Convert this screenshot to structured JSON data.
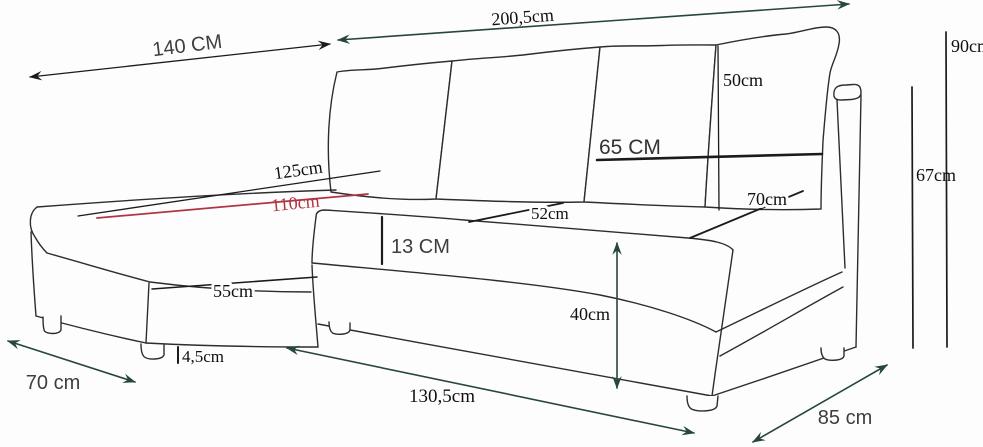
{
  "diagram": {
    "kind": "corner-sofa dimension drawing",
    "background": "#fdfdfd",
    "palette": {
      "sofa_outline": "#2d2d2d",
      "black_dimension": "#1b1b1b",
      "green_dimension": "#26473a",
      "red_dimension": "#b13441",
      "sans_label_color": "#3e3e3e",
      "serif_label_color": "#101010"
    },
    "dims": {
      "d140": {
        "label": "140 CM"
      },
      "d200_5": {
        "label": "200,5cm"
      },
      "d90": {
        "label": "90cm"
      },
      "d67": {
        "label": "67cm"
      },
      "d50": {
        "label": "50cm"
      },
      "d65": {
        "label": "65 CM"
      },
      "d70_seat": {
        "label": "70cm"
      },
      "d52": {
        "label": "52cm"
      },
      "d13": {
        "label": "13 CM"
      },
      "d125": {
        "label": "125cm"
      },
      "d110": {
        "label": "110cm"
      },
      "d55": {
        "label": "55cm"
      },
      "d4_5": {
        "label": "4,5cm"
      },
      "d70_width": {
        "label": "70 cm"
      },
      "d130_5": {
        "label": "130,5cm"
      },
      "d85": {
        "label": "85 cm"
      },
      "d40": {
        "label": "40cm"
      }
    }
  }
}
